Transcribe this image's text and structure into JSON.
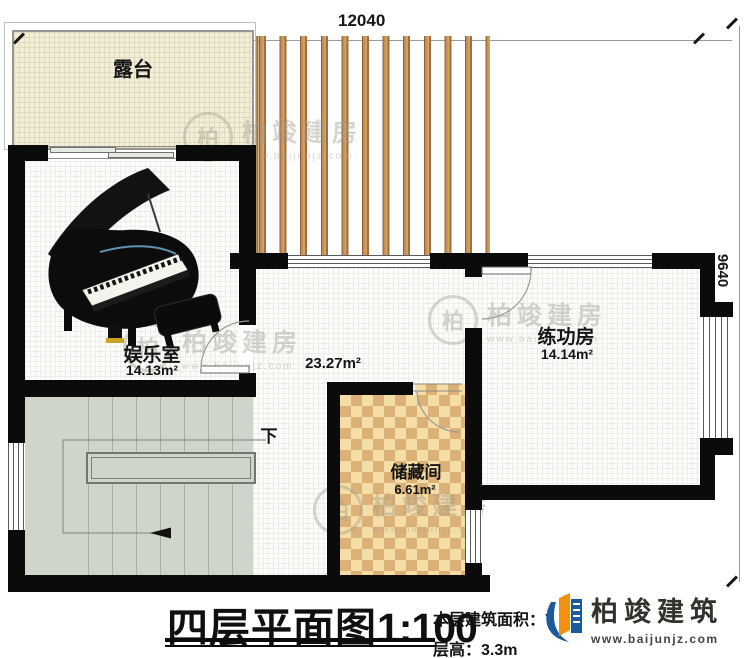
{
  "plan": {
    "dimensions": {
      "top": "12040",
      "right": "9640"
    },
    "rooms": {
      "terrace": {
        "name": "露台"
      },
      "entertainment": {
        "name": "娱乐室",
        "area": "14.13m²"
      },
      "hallway": {
        "area": "23.27m²"
      },
      "practice": {
        "name": "练功房",
        "area": "14.14m²"
      },
      "storage": {
        "name": "储藏间",
        "area": "6.61m²"
      }
    },
    "stairs": {
      "down_label": "下"
    }
  },
  "watermark": {
    "logo_char": "柏",
    "brand": "柏竣建房",
    "url": "www.baijunjz.com"
  },
  "footer": {
    "title": "四层平面图",
    "scale": "1:100",
    "area_label": "本层建筑面积：",
    "area_value_visible": "7",
    "area_sup_visible": "²",
    "floor_height_label": "层高：",
    "floor_height_value": "3.3m",
    "brand": "柏竣建筑",
    "brand_url": "www.baijunjz.com"
  },
  "colors": {
    "wall": "#0b0b0b",
    "wood_slat": "#c68e52",
    "checker": "#dcb178",
    "stair": "#d0d5cb",
    "terrace": "#f2eed9",
    "logo_blue": "#1c5aa0",
    "logo_orange": "#f29111"
  }
}
